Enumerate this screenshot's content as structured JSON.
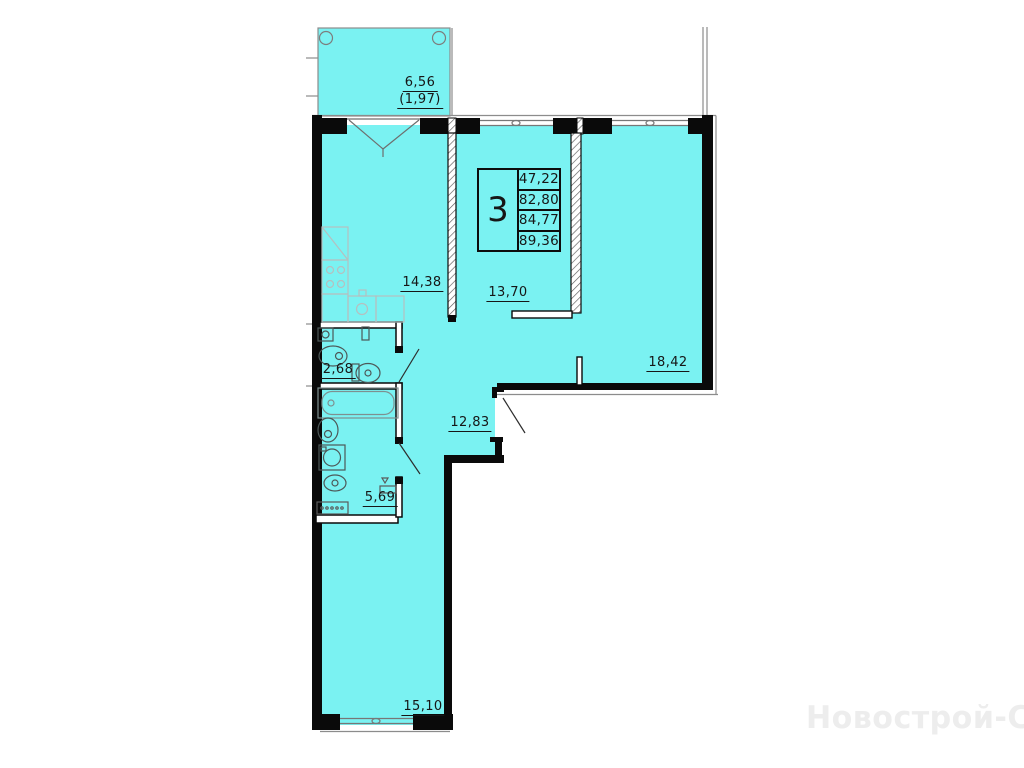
{
  "watermark": {
    "text": "Новострой-СПб"
  },
  "info_table": {
    "flat_number": "3",
    "areas": [
      "47,22",
      "82,80",
      "84,77",
      "89,36"
    ]
  },
  "room_labels": {
    "balcony": {
      "area": "6,56",
      "area_coeff": "(1,97)"
    },
    "kitchen_living": {
      "area": "14,38"
    },
    "room_13": {
      "area": "13,70"
    },
    "bedroom_18": {
      "area": "18,42"
    },
    "wc": {
      "area": "2,68"
    },
    "hallway": {
      "area": "12,83"
    },
    "bathroom": {
      "area": "5,69"
    },
    "bedroom_15": {
      "area": "15,10"
    }
  },
  "colors": {
    "room_fill": "#7af2f2",
    "wall": "#0a0a0a",
    "thin_line": "#8c8c8c",
    "kitchen_fixture_line": "#b5c0c0",
    "sanitary_fixture_line": "#4d5858",
    "label_text": "#161616",
    "watermark": "#ededed"
  }
}
